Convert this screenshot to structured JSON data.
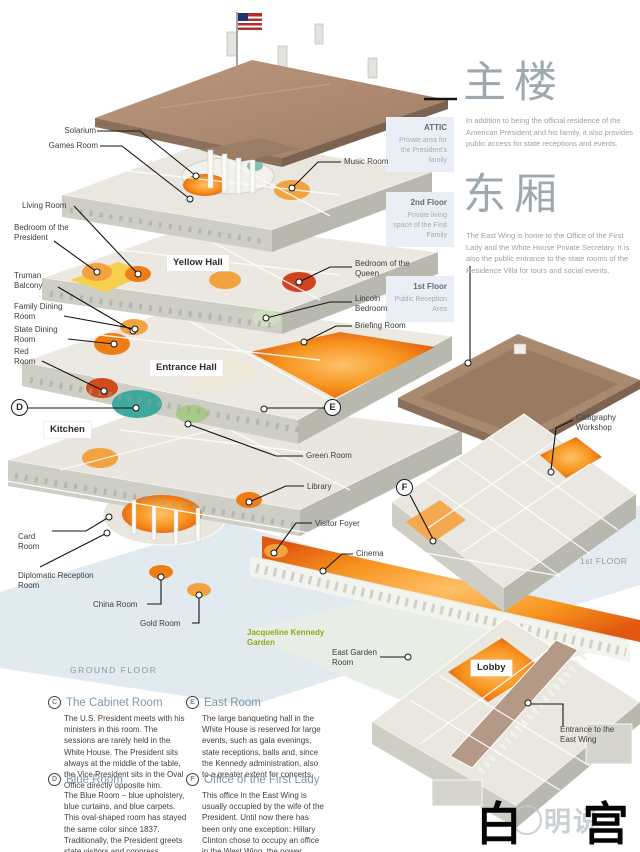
{
  "headers": {
    "main_building": {
      "heading": "主楼",
      "body": "In addition to being the official residence of the American President and his family, it also provides public access for state receptions and events."
    },
    "east_wing": {
      "heading": "东厢",
      "body": "The East Wing is home to the Office of the First Lady and the White House Private Secretary. It is also the public entrance to the state rooms of the Residence Villa for tours and social events."
    }
  },
  "floor_tags": [
    {
      "title": "ATTIC",
      "subtitle": "Private area for the President's family"
    },
    {
      "title": "2nd Floor",
      "subtitle": "Private living space of the First Family"
    },
    {
      "title": "1st Floor",
      "subtitle": "Public Reception Area"
    }
  ],
  "room_labels": {
    "solarium": "Solarium",
    "games_room": "Games Room",
    "music_room": "Music Room",
    "living_room": "Living Room",
    "bedroom_president": "Bedroom of the President",
    "truman_balcony": "Truman Balcony",
    "family_dining": "Family Dining Room",
    "state_dining": "State Dining Room",
    "red_room": "Red Room",
    "queen_bedroom": "Bedroom of the Queen",
    "lincoln_bedroom": "Lincoln Bedroom",
    "briefing_room": "Briefing Room",
    "green_room": "Green Room",
    "library": "Library",
    "visitor_foyer": "Visitor Foyer",
    "cinema": "Cinema",
    "card_room": "Card Room",
    "diplomatic": "Diplomatic Reception Room",
    "china_room": "China Room",
    "gold_room": "Gold Room",
    "east_garden": "East Garden Room",
    "calligraphy": "Calligraphy Workshop",
    "entrance_east": "Entrance to the East Wing"
  },
  "boxed_labels": {
    "yellow_hall": "Yellow Hall",
    "entrance_hall": "Entrance Hall",
    "kitchen": "Kitchen",
    "lobby": "Lobby"
  },
  "markers": {
    "d": "D",
    "e": "E",
    "f": "F"
  },
  "captions": {
    "ground_floor": "GROUND FLOOR",
    "first_floor": "1st FLOOR",
    "garden": "Jacqueline Kennedy Garden"
  },
  "legend": [
    {
      "letter": "C",
      "title": "The Cabinet Room",
      "body": "The U.S. President meets with his ministers in this room. The sessions are rarely held in the White House. The President sits always at the middle of the table, the Vice President sits in the Oval Office directly opposite him."
    },
    {
      "letter": "E",
      "title": "East Room",
      "body": "The large banqueting hall in the White House is reserved for large events, such as gala evenings, state receptions, balls and, since the Kennedy administration, also to a greater extent for concerts."
    },
    {
      "letter": "D",
      "title": "Blue Room",
      "body": "The Blue Room – blue upholstery, blue curtains, and blue carpets. This oval-shaped room has stayed the same color since 1837. Traditionally, the President greets state visitors and congress representatives here."
    },
    {
      "letter": "F",
      "title": "Office of the First Lady",
      "body": "This office in the East Wing is usually occupied by the wife of the President. Until now there has been only one exception: Hillary Clinton chose to occupy an office in the West Wing, the power center of the White House."
    }
  ],
  "footer": {
    "title": "白 宫",
    "watermark": "明说"
  },
  "colors": {
    "accent_orange": "#ef7d15",
    "roof_brown": "#ac8a70",
    "panel_blue": "#e9eff4",
    "heading_gray": "#9da8af",
    "legend_blue": "#7e99aa",
    "garden_green": "#8cab1c"
  }
}
